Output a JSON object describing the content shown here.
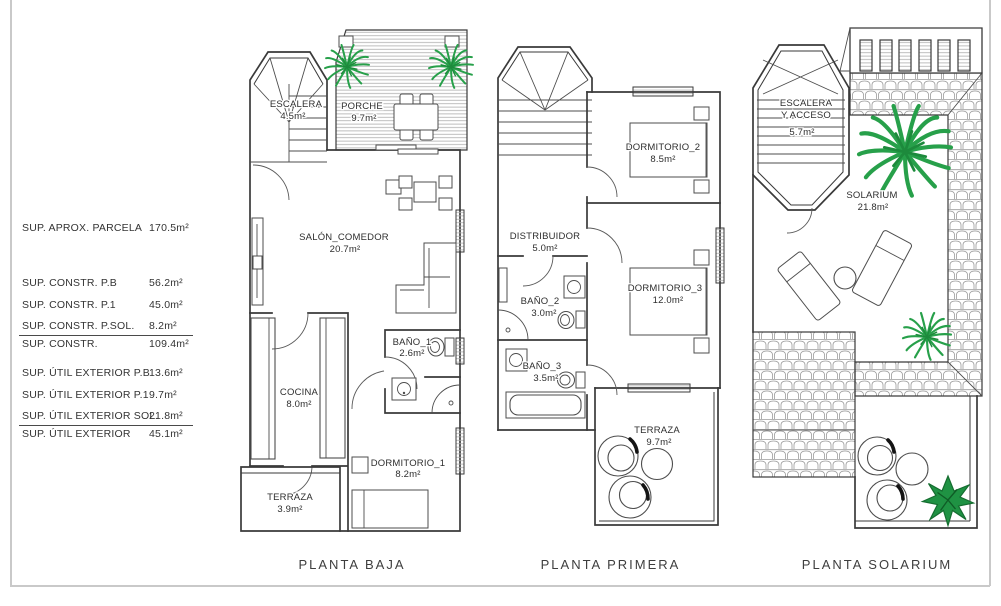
{
  "legend": {
    "rows": [
      {
        "label": "SUP. APROX. PARCELA",
        "value": "170.5m²"
      },
      {
        "label": "SUP. CONSTR. P.B",
        "value": "56.2m²"
      },
      {
        "label": "SUP. CONSTR. P.1",
        "value": "45.0m²"
      },
      {
        "label": "SUP. CONSTR. P.SOL.",
        "value": "8.2m²"
      },
      {
        "label": "SUP. CONSTR.",
        "value": "109.4m²"
      },
      {
        "label": "SUP. ÚTIL EXTERIOR P.B",
        "value": "13.6m²"
      },
      {
        "label": "SUP. ÚTIL EXTERIOR P.1",
        "value": "9.7m²"
      },
      {
        "label": "SUP. ÚTIL EXTERIOR SOL.",
        "value": "21.8m²"
      },
      {
        "label": "SUP. ÚTIL EXTERIOR",
        "value": "45.1m²"
      }
    ]
  },
  "plans": {
    "baja": {
      "title": "PLANTA BAJA",
      "rooms": {
        "escalera": {
          "name": "ESCALERA",
          "area": "4.5m²"
        },
        "porche": {
          "name": "PORCHE",
          "area": "9.7m²"
        },
        "salon": {
          "name": "SALÓN_COMEDOR",
          "area": "20.7m²"
        },
        "bano1": {
          "name": "BAÑO_1",
          "area": "2.6m²"
        },
        "cocina": {
          "name": "COCINA",
          "area": "8.0m²"
        },
        "dormitorio1": {
          "name": "DORMITORIO_1",
          "area": "8.2m²"
        },
        "terraza": {
          "name": "TERRAZA",
          "area": "3.9m²"
        }
      }
    },
    "primera": {
      "title": "PLANTA PRIMERA",
      "rooms": {
        "distribuidor": {
          "name": "DISTRIBUIDOR",
          "area": "5.0m²"
        },
        "dormitorio2": {
          "name": "DORMITORIO_2",
          "area": "8.5m²"
        },
        "bano2": {
          "name": "BAÑO_2",
          "area": "3.0m²"
        },
        "bano3": {
          "name": "BAÑO_3",
          "area": "3.5m²"
        },
        "dormitorio3": {
          "name": "DORMITORIO_3",
          "area": "12.0m²"
        },
        "terraza": {
          "name": "TERRAZA",
          "area": "9.7m²"
        }
      }
    },
    "solarium": {
      "title": "PLANTA SOLARIUM",
      "rooms": {
        "escalera": {
          "name": "ESCALERA",
          "name2": "Y ACCESO",
          "area": "5.7m²"
        },
        "solarium": {
          "name": "SOLARIUM",
          "area": "21.8m²"
        }
      }
    }
  },
  "colors": {
    "plant_green": "#27a04a",
    "plant_green_dark": "#1d8a3c",
    "wall_line": "#3a3a3a",
    "hatch_gray": "#acacac",
    "tile_gray": "#9b9b9b",
    "sheet_border": "#c9c9c9"
  }
}
